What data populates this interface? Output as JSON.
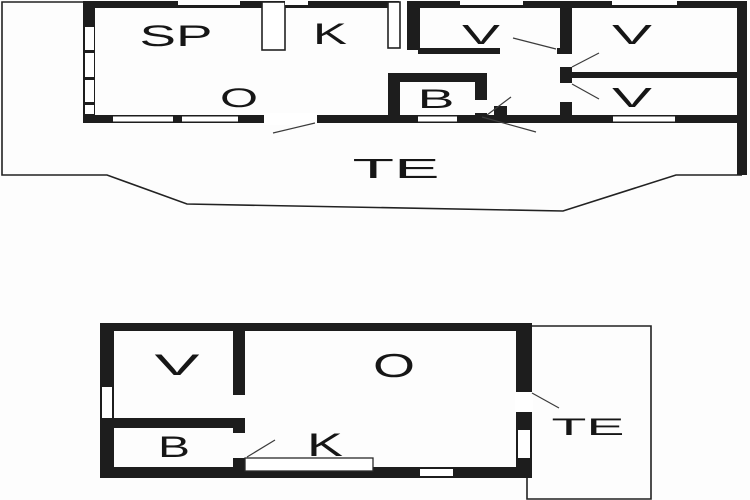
{
  "diagram": {
    "type": "floor-plan",
    "background_color": "#fdfdfd",
    "wall_color": "#1d1d1d",
    "plans": [
      {
        "id": "upper-plan",
        "rooms": [
          {
            "label": "SP"
          },
          {
            "label": "K"
          },
          {
            "label": "V"
          },
          {
            "label": "V"
          },
          {
            "label": "V"
          },
          {
            "label": "O"
          },
          {
            "label": "B"
          }
        ],
        "terrace": {
          "label": "TE"
        }
      },
      {
        "id": "lower-plan",
        "rooms": [
          {
            "label": "V"
          },
          {
            "label": "O"
          },
          {
            "label": "B"
          },
          {
            "label": "K"
          }
        ],
        "terrace": {
          "label": "TE"
        }
      }
    ]
  }
}
